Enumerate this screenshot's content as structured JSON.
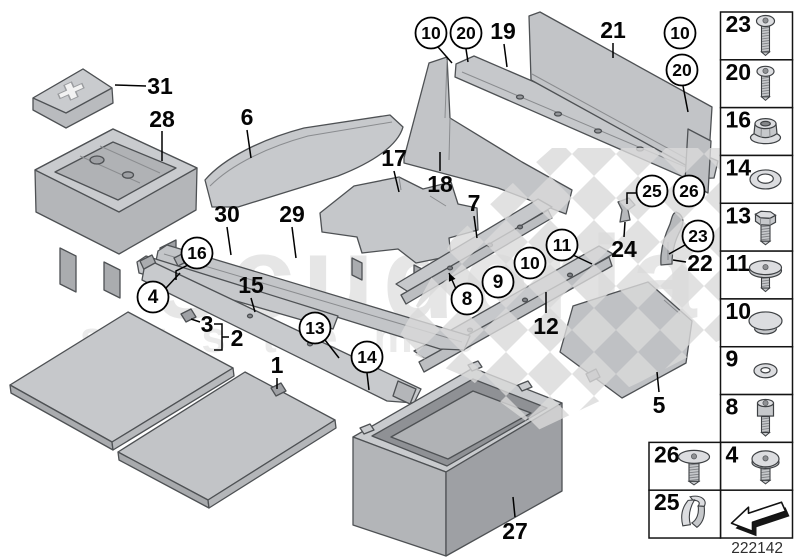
{
  "watermark": {
    "line1": "scuderia",
    "line2": "s y s t e m s"
  },
  "drawing_number": "222142",
  "callouts": {
    "plain": [
      {
        "ref": "31",
        "x": 160,
        "y": 86,
        "leader": [
          [
            146,
            86
          ],
          [
            115,
            85
          ]
        ]
      },
      {
        "ref": "28",
        "x": 162,
        "y": 119,
        "leader": [
          [
            162,
            131
          ],
          [
            162,
            161
          ]
        ]
      },
      {
        "ref": "6",
        "x": 247,
        "y": 117,
        "leader": [
          [
            247,
            130
          ],
          [
            251,
            158
          ]
        ]
      },
      {
        "ref": "30",
        "x": 227,
        "y": 214,
        "leader": [
          [
            227,
            227
          ],
          [
            231,
            255
          ]
        ]
      },
      {
        "ref": "29",
        "x": 292,
        "y": 214,
        "leader": [
          [
            292,
            227
          ],
          [
            296,
            258
          ]
        ]
      },
      {
        "ref": "17",
        "x": 394,
        "y": 158,
        "leader": [
          [
            394,
            171
          ],
          [
            399,
            192
          ]
        ]
      },
      {
        "ref": "18",
        "x": 440,
        "y": 184,
        "leader": [
          [
            440,
            171
          ],
          [
            440,
            152
          ]
        ]
      },
      {
        "ref": "7",
        "x": 474,
        "y": 203,
        "leader": [
          [
            474,
            216
          ],
          [
            477,
            238
          ]
        ]
      },
      {
        "ref": "19",
        "x": 503,
        "y": 31,
        "leader": [
          [
            504,
            44
          ],
          [
            507,
            67
          ]
        ]
      },
      {
        "ref": "21",
        "x": 613,
        "y": 30,
        "leader": [
          [
            613,
            43
          ],
          [
            613,
            58
          ]
        ]
      },
      {
        "ref": "24",
        "x": 624,
        "y": 249,
        "leader": [
          [
            624,
            237
          ],
          [
            625,
            222
          ]
        ]
      },
      {
        "ref": "22",
        "x": 700,
        "y": 263,
        "leader": [
          [
            686,
            262
          ],
          [
            673,
            260
          ]
        ]
      },
      {
        "ref": "12",
        "x": 546,
        "y": 326,
        "leader": [
          [
            546,
            313
          ],
          [
            546,
            292
          ]
        ]
      },
      {
        "ref": "15",
        "x": 251,
        "y": 285,
        "leader": [
          [
            251,
            298
          ],
          [
            255,
            312
          ]
        ]
      },
      {
        "ref": "3",
        "x": 207,
        "y": 324
      },
      {
        "ref": "2",
        "x": 237,
        "y": 338
      },
      {
        "ref": "1",
        "x": 277,
        "y": 365,
        "leader": [
          [
            277,
            378
          ],
          [
            277,
            389
          ]
        ]
      },
      {
        "ref": "5",
        "x": 659,
        "y": 405,
        "leader": [
          [
            659,
            392
          ],
          [
            657,
            372
          ]
        ]
      },
      {
        "ref": "27",
        "x": 515,
        "y": 531,
        "leader": [
          [
            515,
            517
          ],
          [
            513,
            497
          ]
        ]
      }
    ],
    "circled": [
      {
        "ref": "10",
        "x": 431,
        "y": 33,
        "leader": [
          [
            438,
            47
          ],
          [
            452,
            63
          ]
        ]
      },
      {
        "ref": "20",
        "x": 466,
        "y": 33,
        "leader": [
          [
            466,
            49
          ],
          [
            468,
            62
          ]
        ]
      },
      {
        "ref": "10",
        "x": 680,
        "y": 33
      },
      {
        "ref": "20",
        "x": 682,
        "y": 70,
        "leader": [
          [
            683,
            86
          ],
          [
            688,
            112
          ]
        ]
      },
      {
        "ref": "25",
        "x": 652,
        "y": 191,
        "leader": [
          [
            636,
            193
          ],
          [
            627,
            193
          ],
          [
            627,
            204
          ]
        ]
      },
      {
        "ref": "26",
        "x": 689,
        "y": 191
      },
      {
        "ref": "23",
        "x": 698,
        "y": 236,
        "leader": [
          [
            685,
            245
          ],
          [
            669,
            254
          ]
        ]
      },
      {
        "ref": "11",
        "x": 562,
        "y": 245,
        "leader": [
          [
            573,
            255
          ],
          [
            592,
            264
          ]
        ]
      },
      {
        "ref": "10",
        "x": 530,
        "y": 263
      },
      {
        "ref": "9",
        "x": 498,
        "y": 282
      },
      {
        "ref": "8",
        "x": 467,
        "y": 299,
        "leader": [
          [
            456,
            289
          ],
          [
            449,
            273
          ]
        ],
        "arrow": true
      },
      {
        "ref": "16",
        "x": 197,
        "y": 253,
        "leader": [
          [
            188,
            265
          ],
          [
            176,
            271
          ],
          [
            176,
            280
          ]
        ]
      },
      {
        "ref": "4",
        "x": 153,
        "y": 297,
        "leader": [
          [
            166,
            288
          ],
          [
            180,
            273
          ]
        ]
      },
      {
        "ref": "13",
        "x": 315,
        "y": 328,
        "leader": [
          [
            325,
            340
          ],
          [
            339,
            358
          ]
        ]
      },
      {
        "ref": "14",
        "x": 367,
        "y": 357,
        "leader": [
          [
            367,
            373
          ],
          [
            369,
            390
          ]
        ]
      }
    ]
  },
  "legend": {
    "column": [
      {
        "ref": "23",
        "icon": "torx-screw-long"
      },
      {
        "ref": "20",
        "icon": "torx-screw"
      },
      {
        "ref": "16",
        "icon": "flange-nut"
      },
      {
        "ref": "14",
        "icon": "washer-large"
      },
      {
        "ref": "13",
        "icon": "hex-bolt"
      },
      {
        "ref": "11",
        "icon": "body-screw"
      },
      {
        "ref": "10",
        "icon": "blanking-plug"
      },
      {
        "ref": "9",
        "icon": "washer-small"
      },
      {
        "ref": "8",
        "icon": "socket-screw"
      },
      {
        "ref": "4",
        "icon": "pan-head-screw"
      },
      {
        "ref": "",
        "icon": "direction-arrow"
      }
    ],
    "extra_column": [
      {
        "ref": "26",
        "icon": "flat-head-screw"
      },
      {
        "ref": "25",
        "icon": "spring-clip"
      }
    ]
  }
}
